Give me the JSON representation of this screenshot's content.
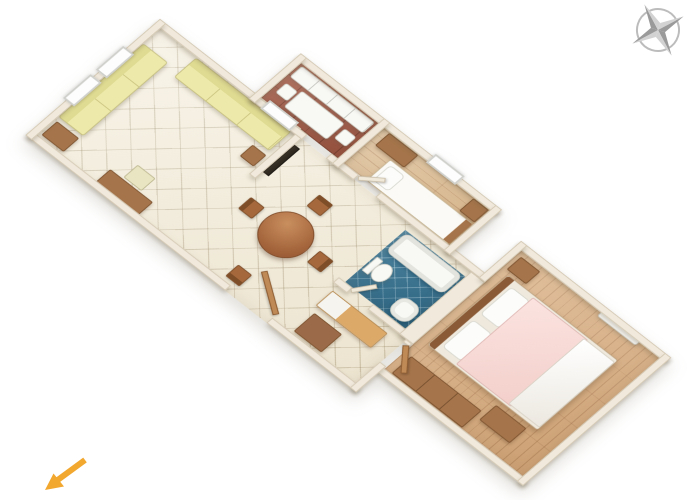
{
  "scene": {
    "description": "3D rendered apartment floor plan shown rotated diagonally on a white background",
    "background": "#ffffff",
    "plan_rotation_deg": 43.5
  },
  "icons": {
    "compass": {
      "name": "compass-rose",
      "position": "top-right",
      "colors": {
        "dark": "#9a9a9a",
        "light": "#d2d2d2",
        "ring": "#bcbcbc"
      }
    },
    "arrow": {
      "name": "direction-arrow",
      "position": "bottom-left",
      "direction": "southwest",
      "color": "#f2a72e"
    }
  },
  "palette": {
    "wall": "#f0e9dc",
    "wall_edge": "#d4c8b2",
    "tile_cream": "#f4eedd",
    "tile_red": "#a65b46",
    "tile_blue": "#31708f",
    "wood_light": "#ddbd92",
    "wood_main": "#d9ae80",
    "sofa_yellow": "#ede9ab",
    "furniture_brown": "#a5744a",
    "bed_pink": "#f3cfca",
    "fixture_white": "#f8f8f5"
  },
  "rooms": [
    {
      "id": "living-room",
      "name": "Living room",
      "floor": "cream ceramic tiles",
      "floor_color": "#f4eedd",
      "furniture": [
        "long yellow sofa",
        "short yellow sofa",
        "two wall windows",
        "small window",
        "side table",
        "desk",
        "desk chair",
        "TV on partition",
        "sofa end table"
      ]
    },
    {
      "id": "dining-area",
      "name": "Dining area",
      "floor": "cream ceramic tiles",
      "floor_color": "#f4eedd",
      "furniture": [
        "round dining table",
        "four dining chairs",
        "open entrance door"
      ]
    },
    {
      "id": "kitchen",
      "name": "Kitchen",
      "floor": "red-brown ceramic tiles",
      "floor_color": "#a65b46",
      "furniture": [
        "white counter",
        "white table",
        "two white chairs"
      ]
    },
    {
      "id": "single-bedroom",
      "name": "Single bedroom",
      "floor": "light wood planks",
      "floor_color": "#ddbd92",
      "furniture": [
        "single bed with white bedding",
        "dresser",
        "nightstand",
        "window",
        "door"
      ]
    },
    {
      "id": "bathroom",
      "name": "Bathroom",
      "floor": "blue mosaic tiles",
      "floor_color": "#31708f",
      "furniture": [
        "bathtub",
        "toilet",
        "washbasin",
        "open door"
      ]
    },
    {
      "id": "hallway",
      "name": "Hallway",
      "floor": "cream ceramic tiles",
      "floor_color": "#f4eedd",
      "furniture": [
        "sideboard",
        "storage cabinet"
      ]
    },
    {
      "id": "double-bedroom",
      "name": "Double bedroom",
      "floor": "wood planks",
      "floor_color": "#d9ae80",
      "furniture": [
        "double bed with pink blanket and white duvet",
        "headboard",
        "two pillows",
        "nightstand",
        "bench",
        "long wardrobe",
        "wall window unit",
        "door"
      ]
    }
  ]
}
